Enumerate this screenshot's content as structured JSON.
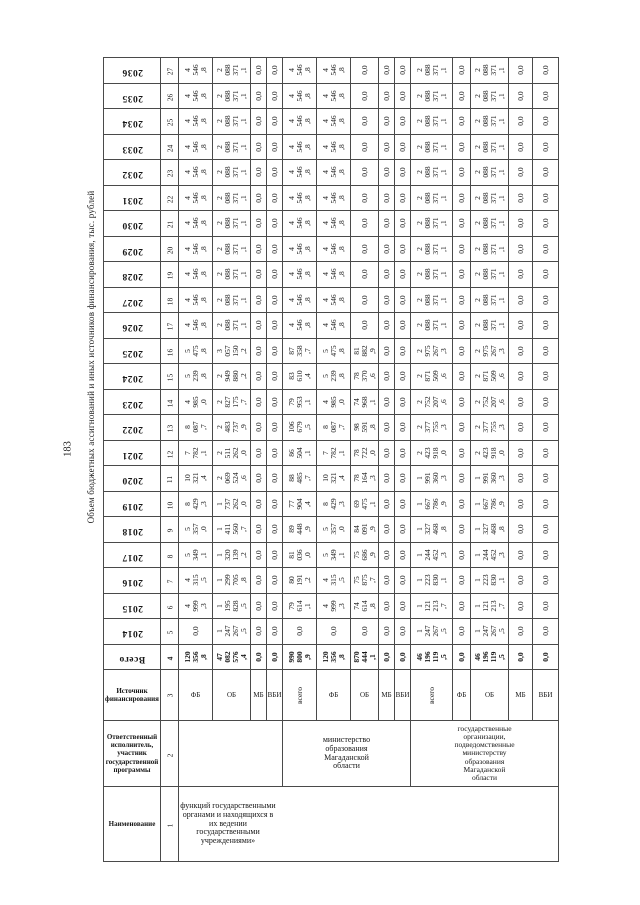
{
  "page": {
    "number": "183",
    "title": "Объем бюджетных ассигнований и иных источников финансирования, тыс. рублей"
  },
  "table": {
    "header_labels": {
      "name": "Наименование",
      "executor": "Ответственный исполнитель, участник государственной программы",
      "source": "Источник финансирования"
    },
    "header_colnums": {
      "name": "1",
      "executor": "2",
      "source": "3"
    },
    "name_value": "функций государственными органами и находящихся в их ведении государственными учреждениями»",
    "executors": {
      "block1": "",
      "block2": "министерство образования Магаданской области",
      "block3": "государственные организации, подведомственные министерству образования Магаданской области"
    },
    "sources": [
      "ФБ",
      "ОБ",
      "МБ",
      "ВБИ",
      "всего",
      "ФБ",
      "ОБ",
      "МБ",
      "ВБИ",
      "всего",
      "ФБ",
      "ОБ",
      "МБ",
      "ВБИ"
    ],
    "rows": [
      {
        "label": "2036",
        "num": "27",
        "bold": false,
        "cells": [
          "4\n546\n,8",
          "2\n088\n371\n,1",
          "0,0",
          "0,0",
          "4\n546\n,8",
          "4\n546\n,8",
          "0,0",
          "0,0",
          "0,0",
          "2\n088\n371\n,1",
          "0,0",
          "2\n088\n371\n,1",
          "0,0",
          "0,0"
        ]
      },
      {
        "label": "2035",
        "num": "26",
        "bold": false,
        "cells": [
          "4\n546\n,8",
          "2\n088\n371\n,1",
          "0,0",
          "0,0",
          "4\n546\n,8",
          "4\n546\n,8",
          "0,0",
          "0,0",
          "0,0",
          "2\n088\n371\n,1",
          "0,0",
          "2\n088\n371\n,1",
          "0,0",
          "0,0"
        ]
      },
      {
        "label": "2034",
        "num": "25",
        "bold": false,
        "cells": [
          "4\n546\n,8",
          "2\n088\n371\n,1",
          "0,0",
          "0,0",
          "4\n546\n,8",
          "4\n546\n,8",
          "0,0",
          "0,0",
          "0,0",
          "2\n088\n371\n,1",
          "0,0",
          "2\n088\n371\n,1",
          "0,0",
          "0,0"
        ]
      },
      {
        "label": "2033",
        "num": "24",
        "bold": false,
        "cells": [
          "4\n546\n,8",
          "2\n088\n371\n,1",
          "0,0",
          "0,0",
          "4\n546\n,8",
          "4\n546\n,8",
          "0,0",
          "0,0",
          "0,0",
          "2\n088\n371\n,1",
          "0,0",
          "2\n088\n371\n,1",
          "0,0",
          "0,0"
        ]
      },
      {
        "label": "2032",
        "num": "23",
        "bold": false,
        "cells": [
          "4\n546\n,8",
          "2\n088\n371\n,1",
          "0,0",
          "0,0",
          "4\n546\n,8",
          "4\n546\n,8",
          "0,0",
          "0,0",
          "0,0",
          "2\n088\n371\n,1",
          "0,0",
          "2\n088\n371\n,1",
          "0,0",
          "0,0"
        ]
      },
      {
        "label": "2031",
        "num": "22",
        "bold": false,
        "cells": [
          "4\n546\n,8",
          "2\n088\n371\n,1",
          "0,0",
          "0,0",
          "4\n546\n,8",
          "4\n546\n,8",
          "0,0",
          "0,0",
          "0,0",
          "2\n088\n371\n,1",
          "0,0",
          "2\n088\n371\n,1",
          "0,0",
          "0,0"
        ]
      },
      {
        "label": "2030",
        "num": "21",
        "bold": false,
        "cells": [
          "4\n546\n,8",
          "2\n088\n371\n,1",
          "0,0",
          "0,0",
          "4\n546\n,8",
          "4\n546\n,8",
          "0,0",
          "0,0",
          "0,0",
          "2\n088\n371\n,1",
          "0,0",
          "2\n088\n371\n,1",
          "0,0",
          "0,0"
        ]
      },
      {
        "label": "2029",
        "num": "20",
        "bold": false,
        "cells": [
          "4\n546\n,8",
          "2\n088\n371\n,1",
          "0,0",
          "0,0",
          "4\n546\n,8",
          "4\n546\n,8",
          "0,0",
          "0,0",
          "0,0",
          "2\n088\n371\n,1",
          "0,0",
          "2\n088\n371\n,1",
          "0,0",
          "0,0"
        ]
      },
      {
        "label": "2028",
        "num": "19",
        "bold": false,
        "cells": [
          "4\n546\n,8",
          "2\n088\n371\n,1",
          "0,0",
          "0,0",
          "4\n546\n,8",
          "4\n546\n,8",
          "0,0",
          "0,0",
          "0,0",
          "2\n088\n371\n,1",
          "0,0",
          "2\n088\n371\n,1",
          "0,0",
          "0,0"
        ]
      },
      {
        "label": "2027",
        "num": "18",
        "bold": false,
        "cells": [
          "4\n546\n,8",
          "2\n088\n371\n,1",
          "0,0",
          "0,0",
          "4\n546\n,8",
          "4\n546\n,8",
          "0,0",
          "0,0",
          "0,0",
          "2\n088\n371\n,1",
          "0,0",
          "2\n088\n371\n,1",
          "0,0",
          "0,0"
        ]
      },
      {
        "label": "2026",
        "num": "17",
        "bold": false,
        "cells": [
          "4\n546\n,8",
          "2\n088\n371\n,1",
          "0,0",
          "0,0",
          "4\n546\n,8",
          "4\n546\n,8",
          "0,0",
          "0,0",
          "0,0",
          "2\n088\n371\n,1",
          "0,0",
          "2\n088\n371\n,1",
          "0,0",
          "0,0"
        ]
      },
      {
        "label": "2025",
        "num": "16",
        "bold": false,
        "cells": [
          "5\n475\n,8",
          "3\n057\n150\n,2",
          "0,0",
          "0,0",
          "87\n358\n,7",
          "5\n475\n,8",
          "81\n882\n,9",
          "0,0",
          "0,0",
          "2\n975\n267\n,3",
          "0,0",
          "2\n975\n267\n,3",
          "0,0",
          "0,0"
        ]
      },
      {
        "label": "2024",
        "num": "15",
        "bold": false,
        "cells": [
          "5\n239\n,8",
          "2\n949\n880\n,2",
          "0,0",
          "0,0",
          "83\n610\n,4",
          "5\n239\n,8",
          "78\n370\n,6",
          "0,0",
          "0,0",
          "2\n871\n509\n,6",
          "0,0",
          "2\n871\n509\n,6",
          "0,0",
          "0,0"
        ]
      },
      {
        "label": "2023",
        "num": "14",
        "bold": false,
        "cells": [
          "4\n985\n,0",
          "2\n827\n175\n,7",
          "0,0",
          "0,0",
          "79\n953\n,1",
          "4\n985\n,0",
          "74\n968\n,1",
          "0,0",
          "0,0",
          "2\n752\n207\n,6",
          "0,0",
          "2\n752\n207\n,6",
          "0,0",
          "0,0"
        ]
      },
      {
        "label": "2022",
        "num": "13",
        "bold": false,
        "cells": [
          "8\n087\n,7",
          "2\n483\n737\n,9",
          "0,0",
          "0,0",
          "106\n679\n,5",
          "8\n087\n,7",
          "98\n591\n,8",
          "0,0",
          "0,0",
          "2\n377\n755\n,3",
          "0,0",
          "2\n377\n755\n,3",
          "0,0",
          "0,0"
        ]
      },
      {
        "label": "2021",
        "num": "12",
        "bold": false,
        "cells": [
          "7\n782\n,1",
          "2\n511\n262\n,0",
          "0,0",
          "0,0",
          "86\n504\n,1",
          "7\n782\n,1",
          "78\n722\n,0",
          "0,0",
          "0,0",
          "2\n423\n918\n,0",
          "0,0",
          "2\n423\n918\n,0",
          "0,0",
          "0,0"
        ]
      },
      {
        "label": "2020",
        "num": "11",
        "bold": false,
        "cells": [
          "10\n321\n,4",
          "2\n069\n524\n,6",
          "0,0",
          "0,0",
          "88\n485\n,7",
          "10\n321\n,4",
          "78\n164\n,3",
          "0,0",
          "0,0",
          "1\n991\n360\n,3",
          "0,0",
          "1\n991\n360\n,3",
          "0,0",
          "0,0"
        ]
      },
      {
        "label": "2019",
        "num": "10",
        "bold": false,
        "cells": [
          "8\n429\n,3",
          "1\n737\n262\n,0",
          "0,0",
          "0,0",
          "77\n904\n,4",
          "8\n429\n,3",
          "69\n475\n,1",
          "0,0",
          "0,0",
          "1\n667\n786\n,9",
          "0,0",
          "1\n667\n786\n,9",
          "0,0",
          "0,0"
        ]
      },
      {
        "label": "2018",
        "num": "9",
        "bold": false,
        "cells": [
          "5\n357\n,0",
          "1\n411\n560\n,7",
          "0,0",
          "0,0",
          "89\n448\n,9",
          "5\n357\n,0",
          "84\n091\n,9",
          "0,0",
          "0,0",
          "1\n327\n468\n,8",
          "0,0",
          "1\n327\n468\n,8",
          "0,0",
          "0,0"
        ]
      },
      {
        "label": "2017",
        "num": "8",
        "bold": false,
        "cells": [
          "5\n349\n,1",
          "1\n320\n139\n,2",
          "0,0",
          "0,0",
          "81\n036\n,0",
          "5\n349\n,1",
          "75\n686\n,9",
          "0,0",
          "0,0",
          "1\n244\n452\n,3",
          "0,0",
          "1\n244\n452\n,3",
          "0,0",
          "0,0"
        ]
      },
      {
        "label": "2016",
        "num": "7",
        "bold": false,
        "cells": [
          "4\n315\n,5",
          "1\n299\n705\n,8",
          "0,0",
          "0,0",
          "80\n191\n,2",
          "4\n315\n,5",
          "75\n875\n,7",
          "0,0",
          "0,0",
          "1\n223\n830\n,1",
          "0,0",
          "1\n223\n830\n,1",
          "0,0",
          "0,0"
        ]
      },
      {
        "label": "2015",
        "num": "6",
        "bold": false,
        "cells": [
          "4\n999\n,3",
          "1\n195\n828\n,5",
          "0,0",
          "0,0",
          "79\n614\n,1",
          "4\n999\n,3",
          "74\n614\n,8",
          "0,0",
          "0,0",
          "1\n121\n213\n,7",
          "0,0",
          "1\n121\n213\n,7",
          "0,0",
          "0,0"
        ]
      },
      {
        "label": "2014",
        "num": "5",
        "bold": false,
        "cells": [
          "0,0",
          "1\n247\n267\n,5",
          "0,0",
          "0,0",
          "0,0",
          "0,0",
          "0,0",
          "0,0",
          "0,0",
          "1\n247\n267\n,5",
          "0,0",
          "1\n247\n267\n,5",
          "0,0",
          "0,0"
        ]
      },
      {
        "label": "Всего",
        "num": "4",
        "bold": true,
        "cells": [
          "120\n356\n,8",
          "47\n082\n576\n,4",
          "0,0",
          "0,0",
          "990\n800\n,9",
          "120\n356\n,8",
          "870\n444\n,1",
          "0,0",
          "0,0",
          "46\n196\n119\n,5",
          "0,0",
          "46\n196\n119\n,5",
          "0,0",
          "0,0"
        ]
      }
    ]
  }
}
